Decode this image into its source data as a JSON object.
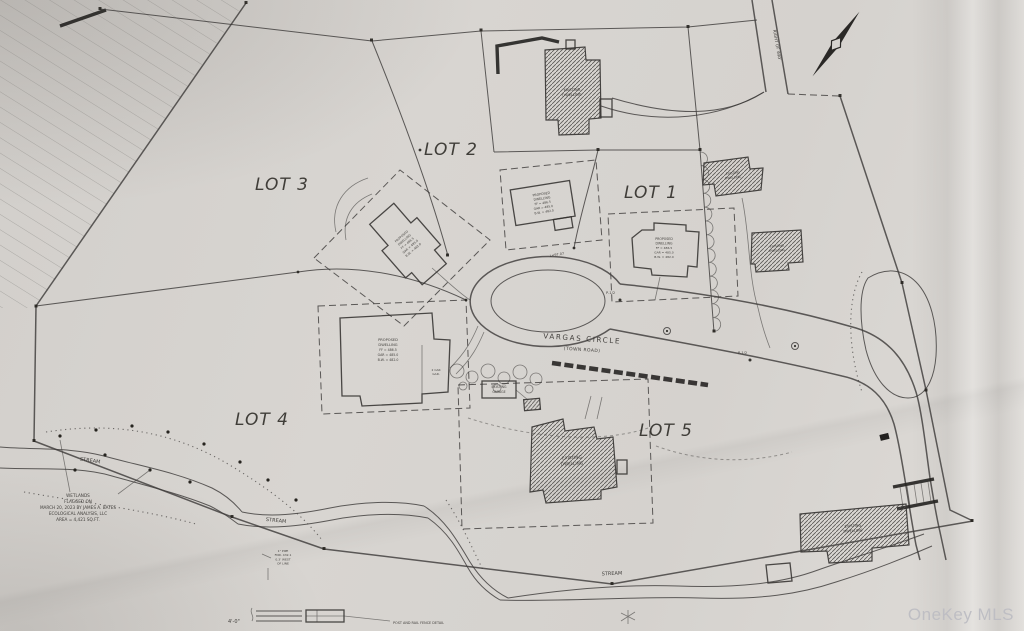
{
  "lots": {
    "lot1": "LOT 1",
    "lot2": "LOT 2",
    "lot3": "LOT 3",
    "lot4": "LOT 4",
    "lot5": "LOT 5"
  },
  "road": {
    "name": "VARGAS CIRCLE",
    "type": "(TOWN ROAD)"
  },
  "labels": {
    "stream": "STREAM",
    "right_of_way": "RIGHT OF WAY",
    "existing": [
      "EXISTING",
      "DWELLING"
    ],
    "proposed": [
      "PROPOSED",
      "DWELLING",
      "FF = 486.5",
      "GAR = 485.0",
      "B.W. = 482.0"
    ],
    "garage_box": [
      "EXISTING",
      "GARAGE"
    ],
    "garage2": [
      "2 CAR",
      "GAR."
    ],
    "pole": "P-1/2",
    "curve": "L=97.07"
  },
  "wetlands_note": [
    "WETLANDS",
    "FLAGGED ON",
    "MARCH 20, 2023 BY JAMES A. BATES",
    "ECOLOGICAL ANALYSIS, LLC",
    "AREA = 4,421 SQ.FT."
  ],
  "survey_note": [
    "1\" PIPE",
    "FND. 432.1",
    "0.3' WEST",
    "OF LINE"
  ],
  "legend": {
    "dim": "4'-0\"",
    "detail_label": "POST AND RAIL FENCE DETAIL"
  },
  "watermark": "OneKey MLS",
  "colors": {
    "paper": "#d6d3cf",
    "ink": "#3e3c3a",
    "watermark": "#bdbdc3"
  }
}
